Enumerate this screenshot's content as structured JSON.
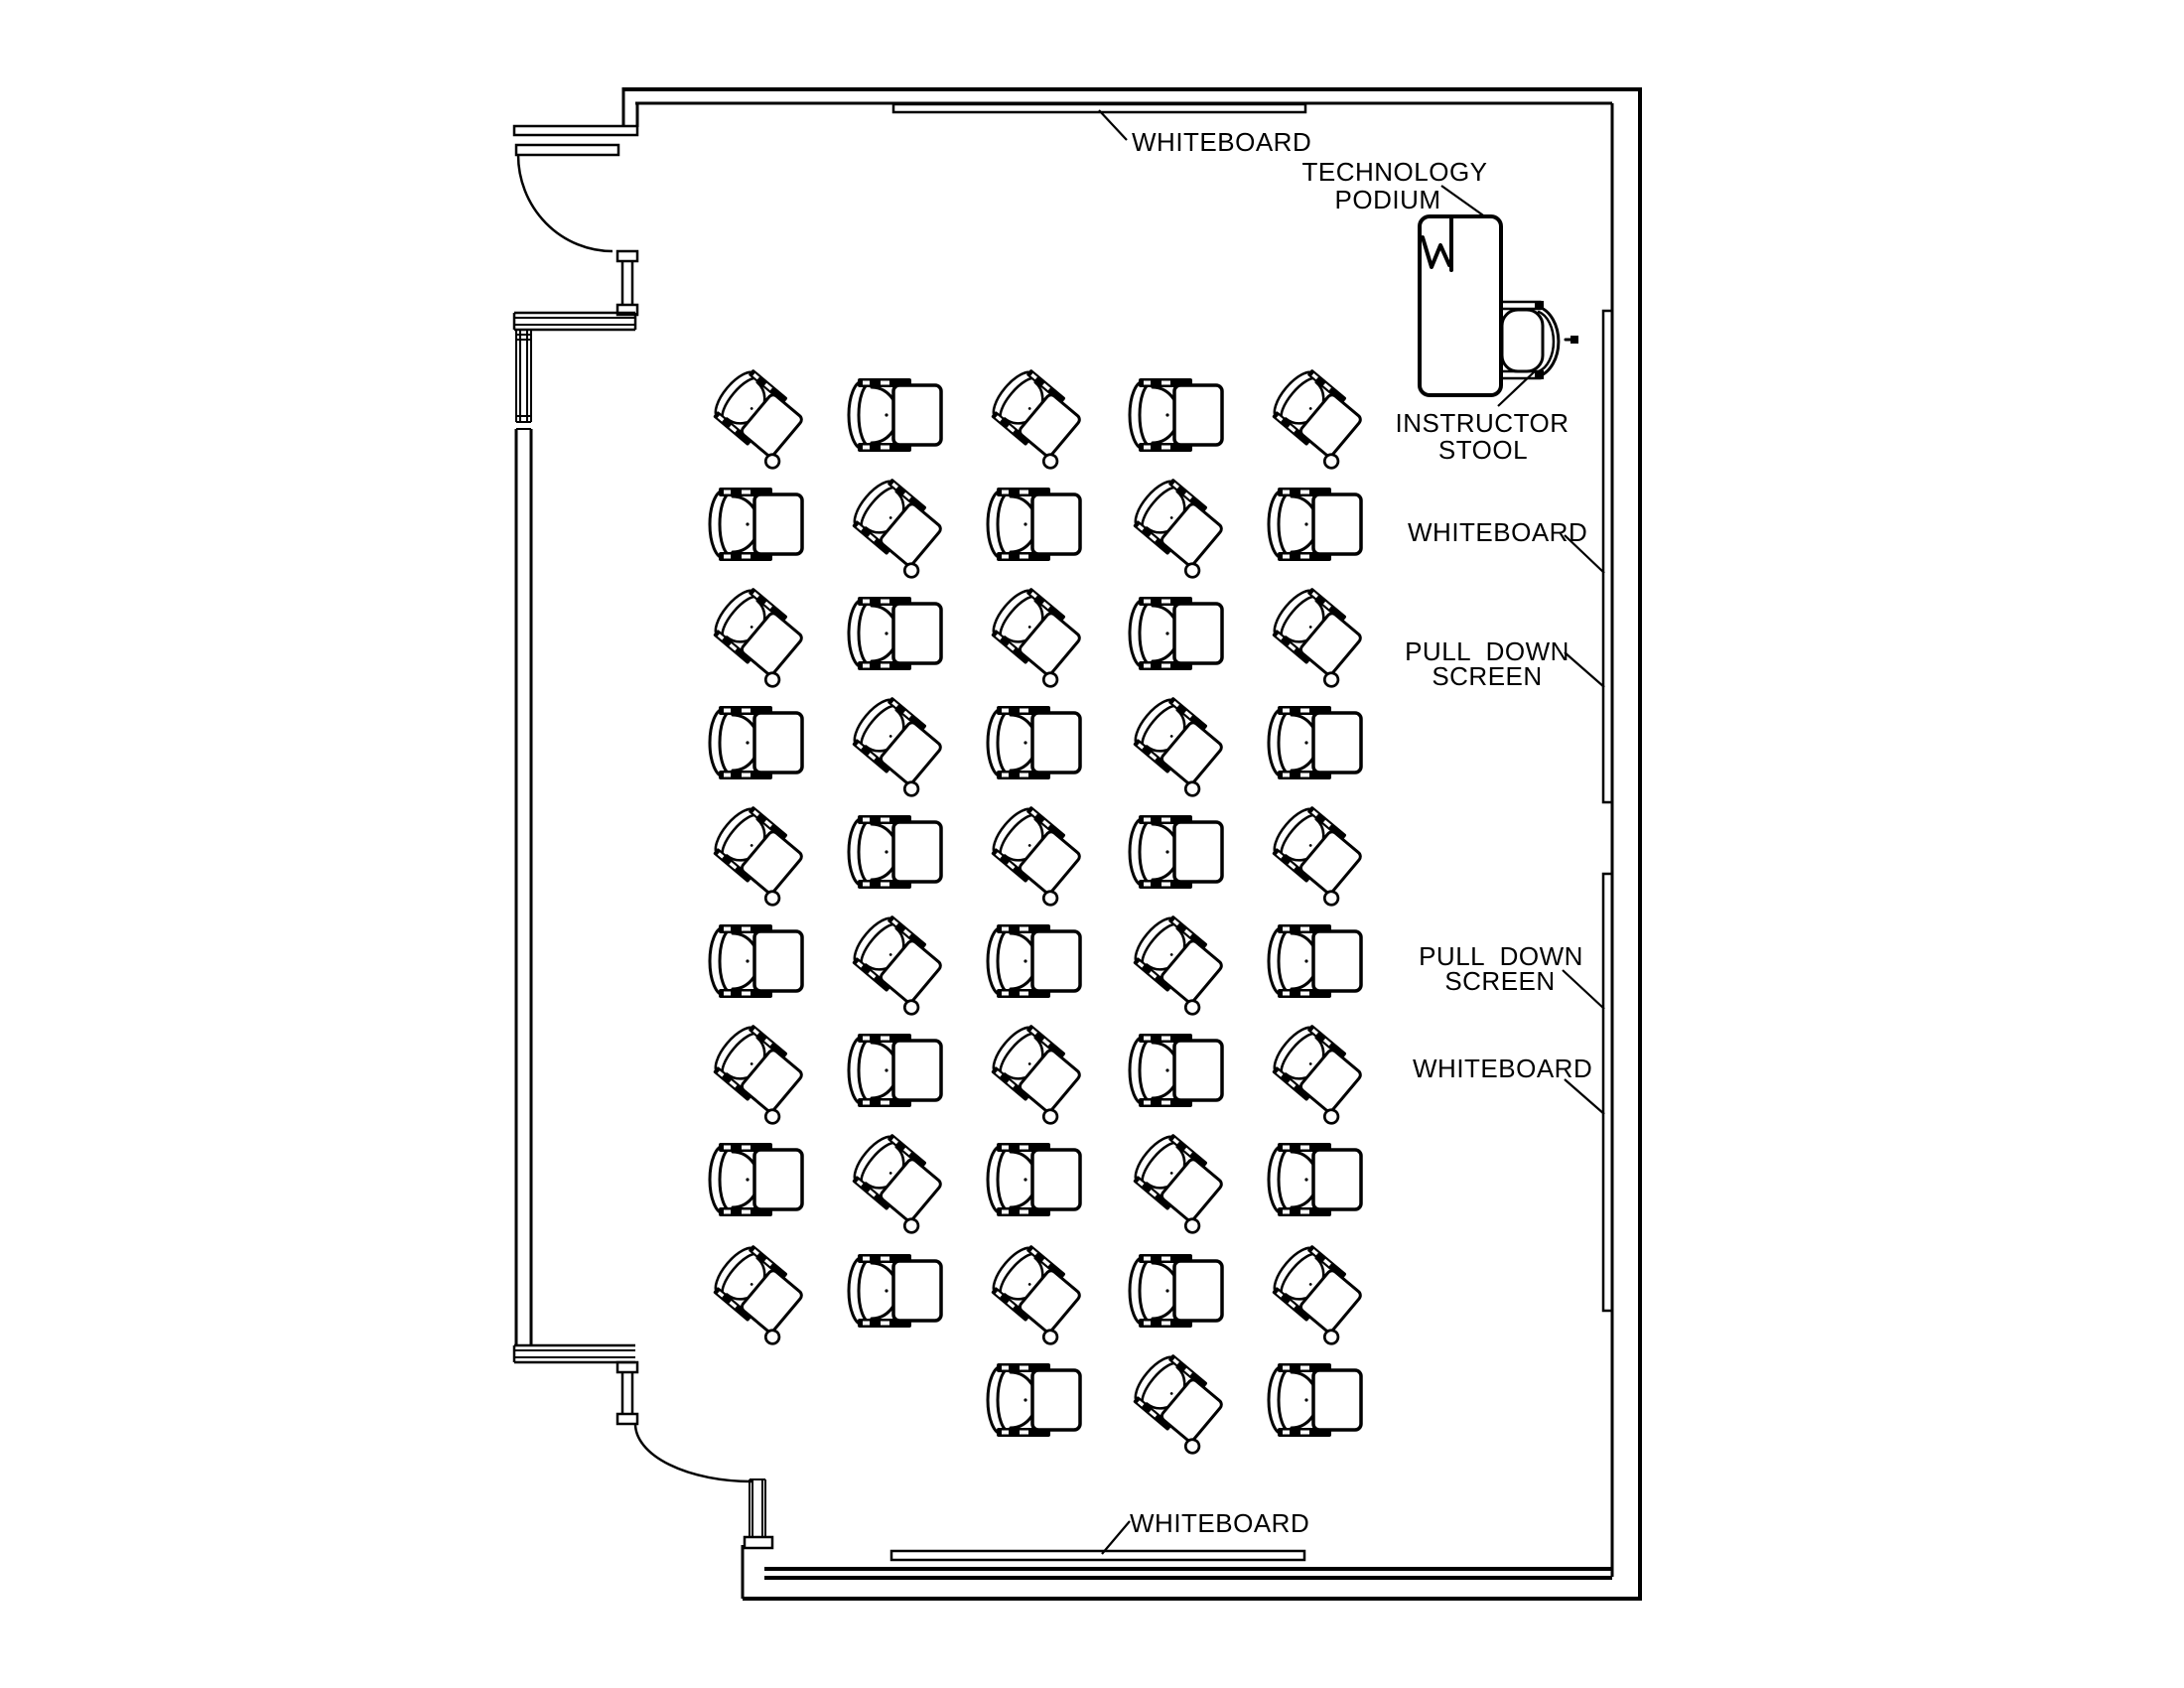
{
  "drawing": {
    "kind": "classroom floor plan",
    "background_color": "#ffffff",
    "line_color": "#000000"
  },
  "annotations": {
    "whiteboard_top": "WHITEBOARD",
    "technology_podium_line1": "TECHNOLOGY",
    "technology_podium_line2": "PODIUM",
    "instructor_stool_line1": "INSTRUCTOR",
    "instructor_stool_line2": "STOOL",
    "whiteboard_right_upper": "WHITEBOARD",
    "pull_down_screen_upper_line1": "PULL  DOWN",
    "pull_down_screen_upper_line2": "SCREEN",
    "pull_down_screen_lower_line1": "PULL  DOWN",
    "pull_down_screen_lower_line2": "SCREEN",
    "whiteboard_right_lower": "WHITEBOARD",
    "whiteboard_bottom": "WHITEBOARD"
  },
  "chairs": {
    "total_count": 48,
    "columns_x": [
      765,
      905,
      1045,
      1188,
      1328
    ],
    "rows_y": [
      418,
      528,
      638,
      748,
      858,
      968,
      1078,
      1188,
      1300,
      1410
    ],
    "layout": [
      [
        "A",
        "B",
        "A",
        "B",
        "A"
      ],
      [
        "B",
        "A",
        "B",
        "A",
        "B"
      ],
      [
        "A",
        "B",
        "A",
        "B",
        "A"
      ],
      [
        "B",
        "A",
        "B",
        "A",
        "B"
      ],
      [
        "A",
        "B",
        "A",
        "B",
        "A"
      ],
      [
        "B",
        "A",
        "B",
        "A",
        "B"
      ],
      [
        "A",
        "B",
        "A",
        "B",
        "A"
      ],
      [
        "B",
        "A",
        "B",
        "A",
        "B"
      ],
      [
        "A",
        "B",
        "A",
        "B",
        "A"
      ],
      [
        "",
        "",
        "B",
        "A",
        "B"
      ]
    ]
  }
}
